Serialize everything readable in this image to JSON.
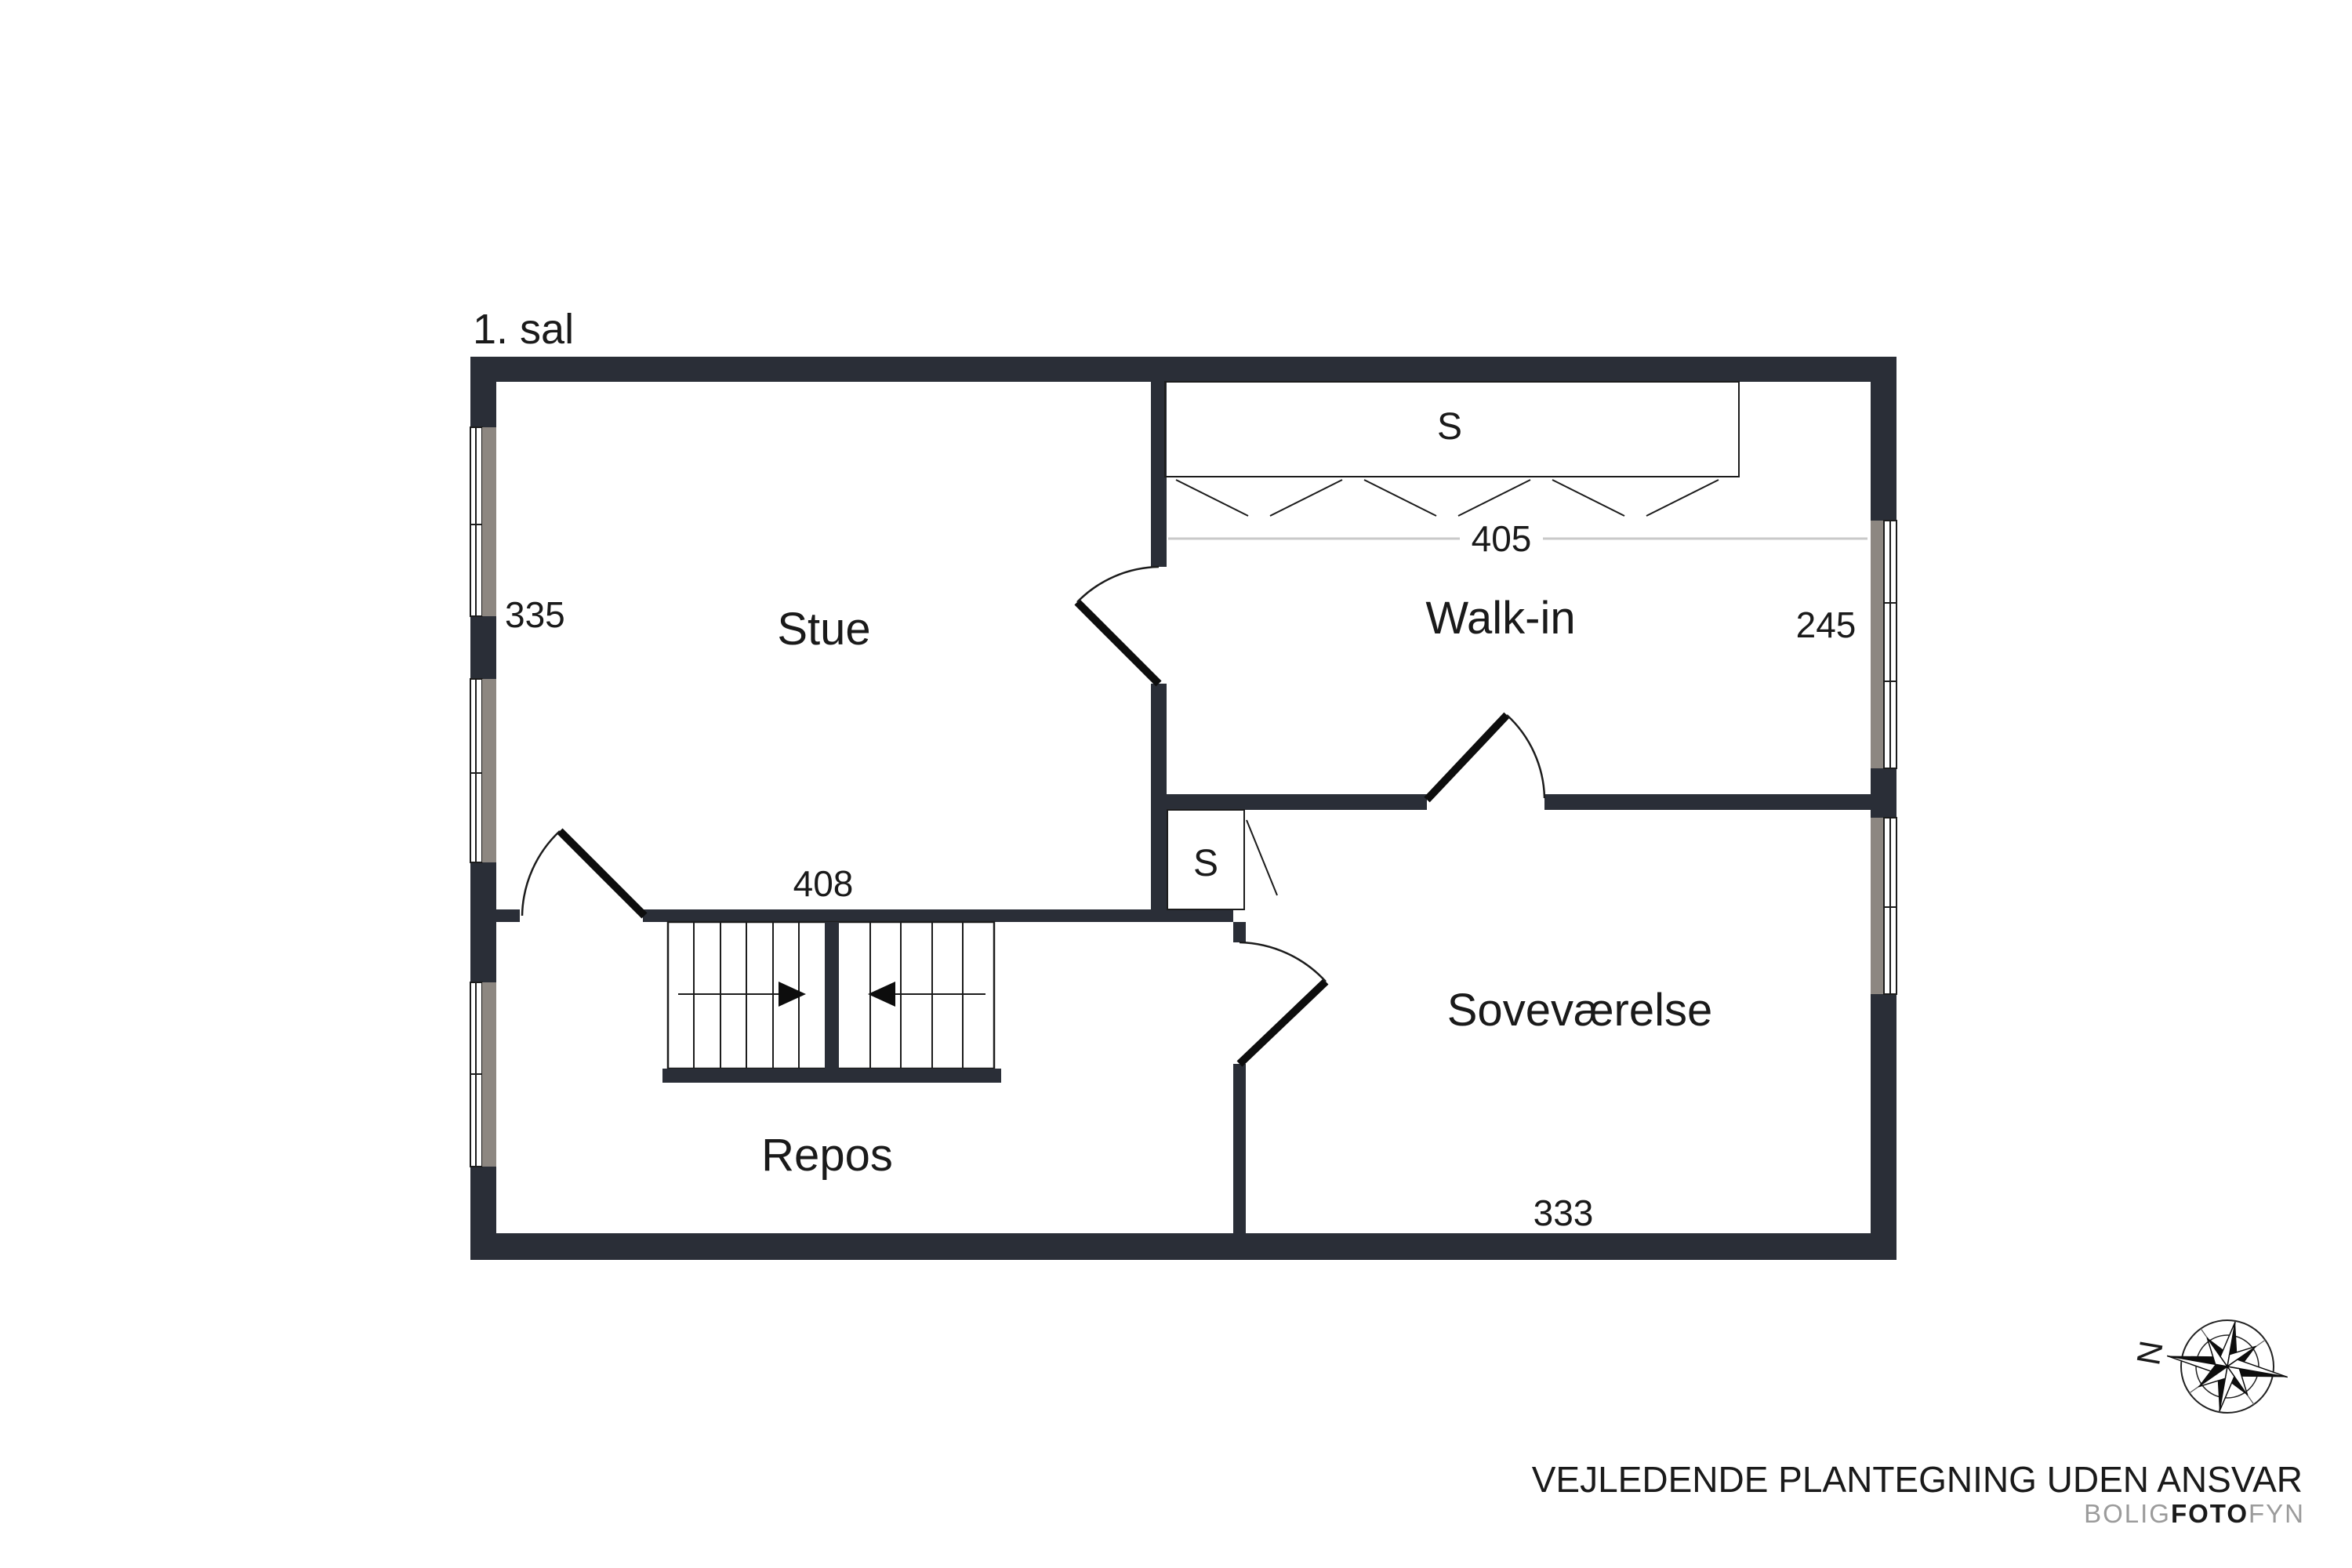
{
  "floor_plan": {
    "floor_label": "1. sal",
    "rooms": [
      {
        "name": "Stue"
      },
      {
        "name": "Walk-in"
      },
      {
        "name": "Soveværelse"
      },
      {
        "name": "Repos"
      }
    ],
    "dimensions": {
      "stue_depth": "335",
      "stue_width": "408",
      "walkin_width": "405",
      "walkin_depth": "245",
      "sovevaerelse_width": "333"
    },
    "closets": {
      "walkin_wardrobe_label": "S",
      "hall_closet_label": "S"
    }
  },
  "compass": {
    "north_label": "N"
  },
  "footer": {
    "disclaimer": "VEJLEDENDE PLANTEGNING UDEN ANSVAR",
    "brand": {
      "part1": "BOLIG",
      "part2": "FOTO",
      "part3": "FYN"
    }
  },
  "colors": {
    "wall": "#2a2e37",
    "window_glass": "#8d8781",
    "dimension_line": "#c9c9c9",
    "text": "#1a1a1a",
    "brand_gray": "#9b9b9b"
  }
}
